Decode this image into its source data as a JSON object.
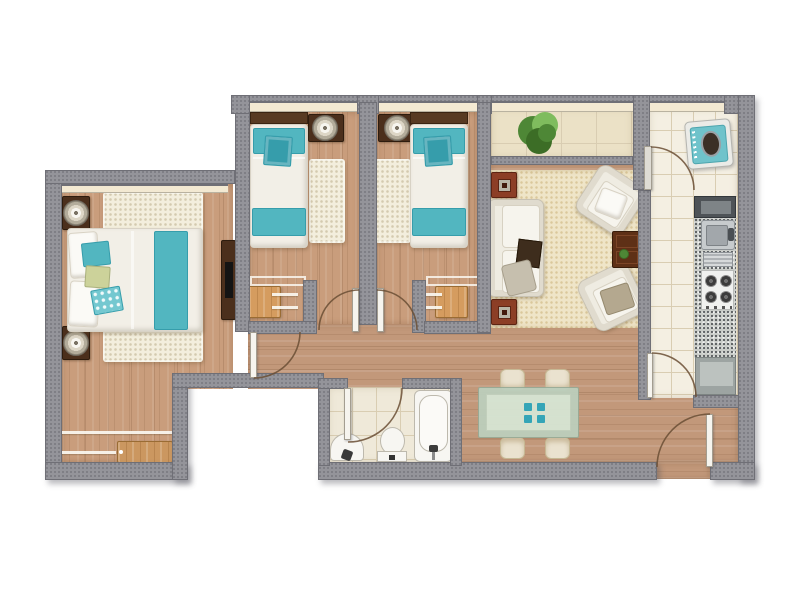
{
  "meta": {
    "type": "architectural-floor-plan",
    "canvas_w": 800,
    "canvas_h": 600,
    "visible_text": "none"
  },
  "colors": {
    "wall": "#94949a",
    "wallEdge": "#6f6f76",
    "sill": "#f3e9d2",
    "woodV": "#c99d7c",
    "woodH": "#c2987a",
    "tileBalcony": "#ebe1c6",
    "tileKitchen": "#f4efe2",
    "tileBath": "#efe9d9",
    "tileLine": "#d9cdb2",
    "shagRug": "#f3eedd",
    "livingRug": "#efe5c8",
    "teal": "#52b6c0",
    "tealDark": "#369dab",
    "tealLight": "#74c8d0",
    "greenPillow": "#ccd29a",
    "linen": "#f2efe7",
    "linenEdge": "#d8d2c5",
    "darkWood": "#4b2f1c",
    "headboard": "#583a22",
    "deskWood": "#d59c5f",
    "dresserWood": "#cb9760",
    "redSideTable": "#8c3e26",
    "coffeeTable": "#5e3016",
    "sofaCream": "#efece2",
    "sofaBorder": "#c8c2b3",
    "cushionDark": "#3e2d1d",
    "throwGray": "#c6bfae",
    "taupe": "#b4a88f",
    "chairCream": "#eae2cf",
    "glassTable": "#bccfbd",
    "glassInner": "#d7e7d6",
    "placematTeal": "#2aa7bc",
    "fixtureWhite": "#f7f6f2",
    "fixtureBorder": "#bdb9ad",
    "steel": "#c7cbcd",
    "steelDark": "#8d9296",
    "graniteBase": "#c9ccc8",
    "counterDark": "#4e5357",
    "counterInner": "#7e8487",
    "fridgeGray": "#9da4a2",
    "fridgeInner": "#bcc2bf",
    "washerTeal": "#6fc3cb",
    "washerDoor": "#3b2f26",
    "plantGreen": "#4e8736",
    "plantDark": "#3c6d26",
    "plantLight": "#7fbc5e",
    "doorArc": "#6b4f35",
    "doorLeaf": "#f6f4ee"
  },
  "rooms": [
    {
      "id": "master-bedroom",
      "furniture": [
        "double-bed",
        "white-pillows",
        "teal-accent-pillows",
        "green-pillow",
        "teal-bed-runner",
        "shag-rug",
        "nightstand-north",
        "nightstand-south",
        "round-lamp-north",
        "round-lamp-south",
        "tv-console",
        "tv",
        "dresser",
        "sliding-closet-lines"
      ]
    },
    {
      "id": "bedroom-2",
      "furniture": [
        "single-bed",
        "wood-headboard",
        "teal-pillow",
        "teal-cushion",
        "teal-foot-band",
        "nightstand-with-lamp",
        "shag-rug",
        "desk",
        "desk-chair-lines"
      ]
    },
    {
      "id": "bedroom-3",
      "furniture": [
        "single-bed",
        "wood-headboard",
        "teal-pillow",
        "teal-cushion",
        "teal-foot-band",
        "nightstand-with-lamp",
        "shag-rug",
        "desk",
        "desk-chair-lines"
      ]
    },
    {
      "id": "living-room",
      "furniture": [
        "cream-area-rug",
        "three-seat-sofa",
        "dark-sofa-tray",
        "gray-throw",
        "armchair-north",
        "armchair-south",
        "coffee-table",
        "side-table-north",
        "side-table-south"
      ]
    },
    {
      "id": "balcony",
      "furniture": [
        "potted-plant",
        "railing"
      ]
    },
    {
      "id": "kitchen",
      "furniture": [
        "washing-machine",
        "dark-counter",
        "granite-countertop",
        "double-sink-with-drainboard",
        "four-burner-stove",
        "refrigerator"
      ]
    },
    {
      "id": "bathroom",
      "furniture": [
        "basin-sink",
        "toilet",
        "bathtub"
      ]
    },
    {
      "id": "dining-area",
      "furniture": [
        "glass-dining-table",
        "four-chairs",
        "four-teal-placemats"
      ]
    },
    {
      "id": "hallway",
      "furniture": []
    }
  ],
  "doors": [
    "master-bedroom-door",
    "bedroom-2-door",
    "bedroom-3-door",
    "bathroom-door",
    "kitchen-north-door",
    "kitchen-south-door",
    "entrance-door"
  ],
  "windows": [
    "master-bedroom-north-window",
    "continuous-north-window-band"
  ]
}
